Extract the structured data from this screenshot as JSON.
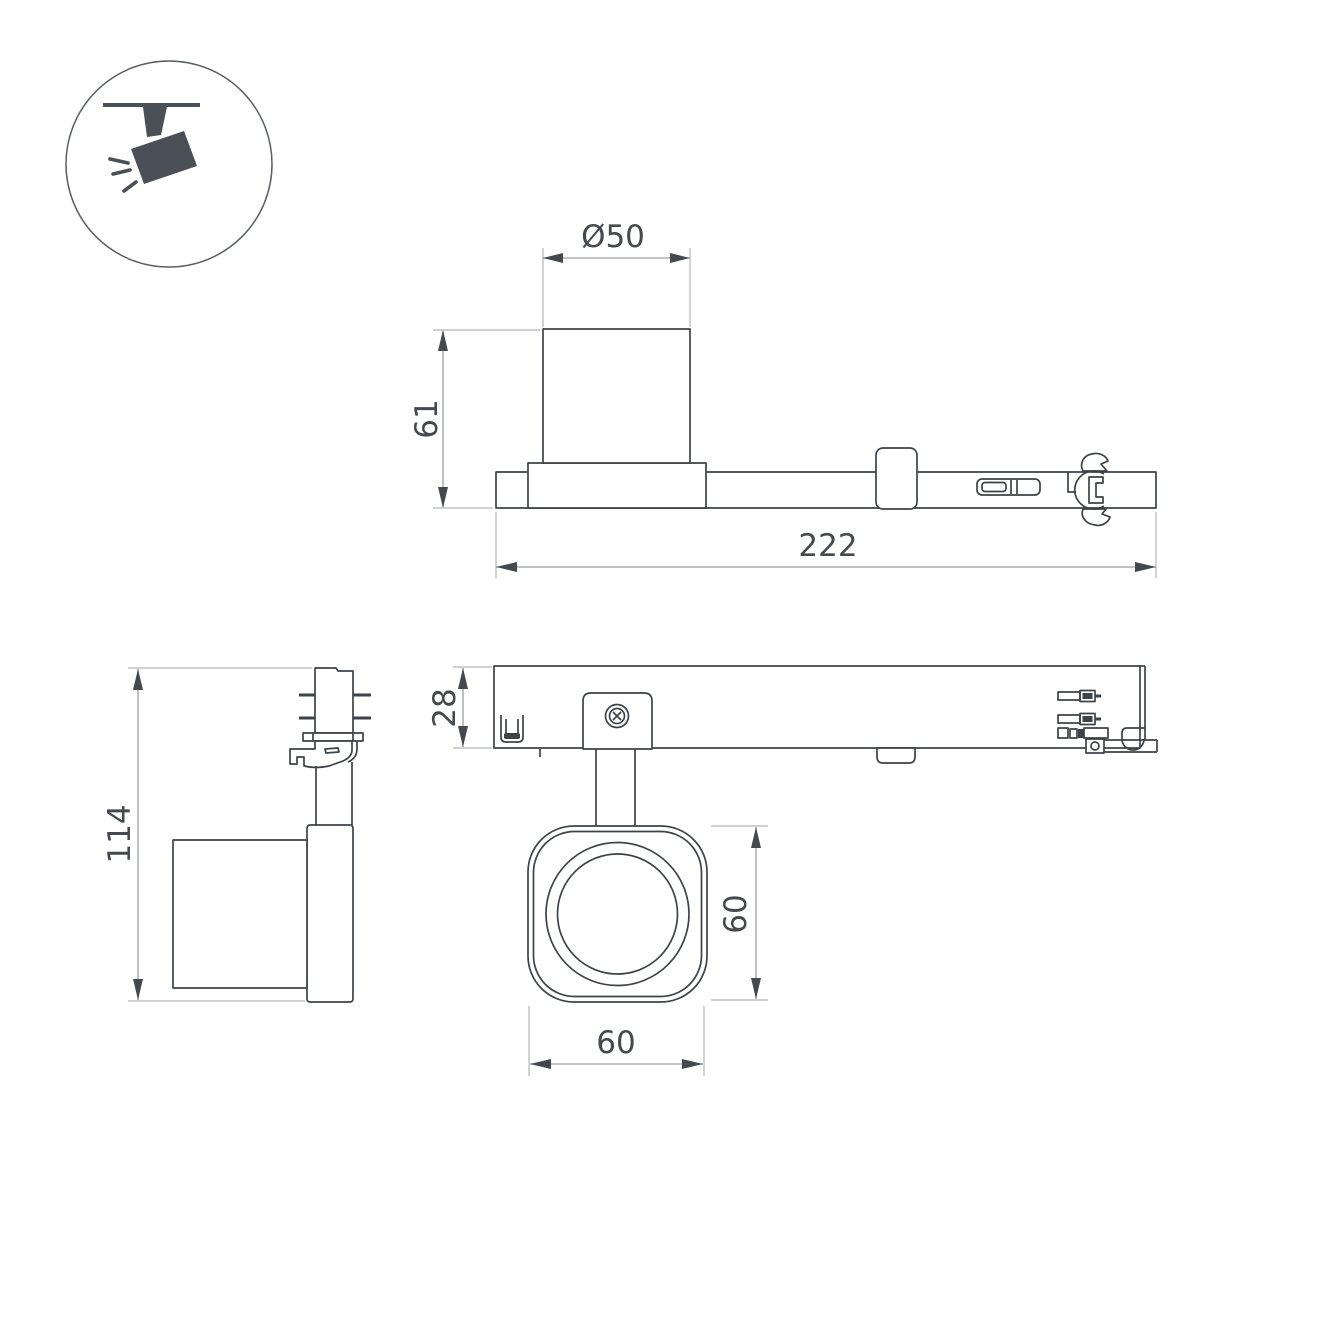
{
  "document": {
    "kind": "technical-drawing",
    "product": "ceiling track spotlight",
    "background": "#ffffff"
  },
  "icon": {
    "name": "ceiling-track-spotlight",
    "color": "#4a5056"
  },
  "views": {
    "track_side_view": {
      "dim_diameter": "Ø50",
      "dim_height": "61",
      "dim_length": "222"
    },
    "luminaire_side_view": {
      "dim_height": "114"
    },
    "track_top_view": {
      "dim_depth": "28",
      "dim_head_height": "60",
      "dim_head_width": "60"
    }
  },
  "colors": {
    "outline": "#3e4348",
    "dimension_line": "#9b9ea1",
    "extension_line": "#b3b6b8",
    "text": "#464a4e",
    "icon": "#4a5056"
  }
}
